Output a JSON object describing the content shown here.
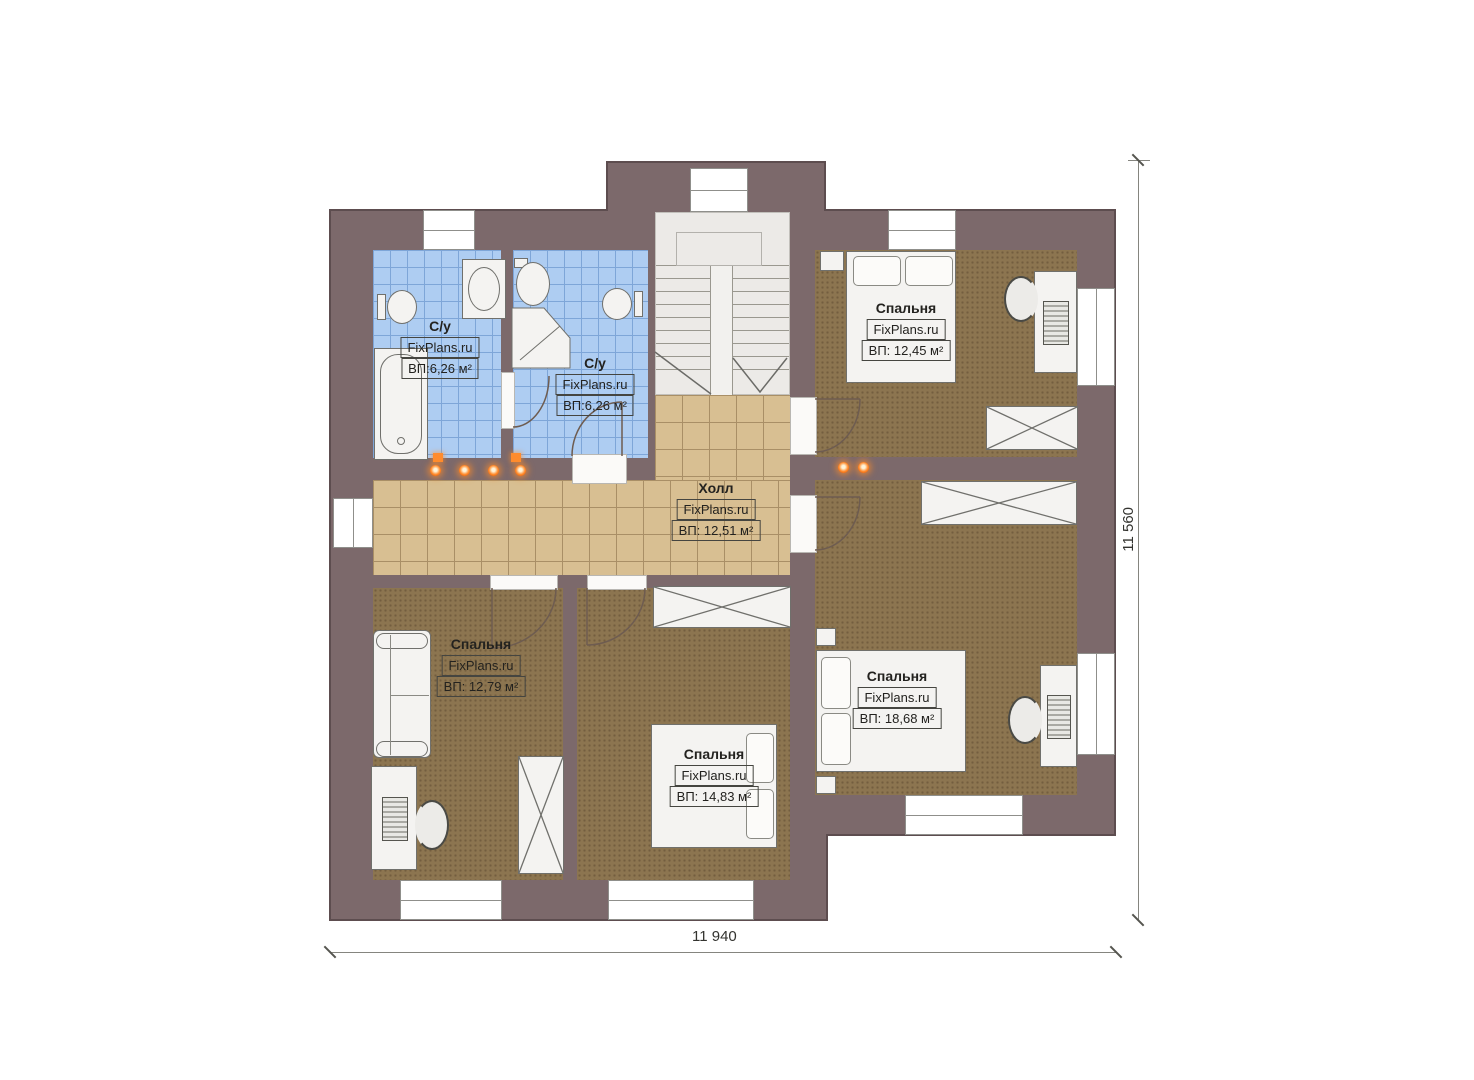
{
  "rooms": {
    "bath_left": {
      "name": "С/у",
      "brand": "FixPlans.ru",
      "area": "ВП:6,26 м²"
    },
    "bath_right": {
      "name": "С/у",
      "brand": "FixPlans.ru",
      "area": "ВП:6,26 м²"
    },
    "hall": {
      "name": "Холл",
      "brand": "FixPlans.ru",
      "area": "ВП: 12,51 м²"
    },
    "bedroom_top_right": {
      "name": "Спальня",
      "brand": "FixPlans.ru",
      "area": "ВП: 12,45 м²"
    },
    "bedroom_bottom_left": {
      "name": "Спальня",
      "brand": "FixPlans.ru",
      "area": "ВП: 12,79 м²"
    },
    "bedroom_bottom_middle": {
      "name": "Спальня",
      "brand": "FixPlans.ru",
      "area": "ВП: 14,83 м²"
    },
    "bedroom_right": {
      "name": "Спальня",
      "brand": "FixPlans.ru",
      "area": "ВП: 18,68 м²"
    }
  },
  "dimensions": {
    "width_total": "11 940",
    "height_total": "11 560"
  },
  "colors": {
    "wall": "#7c696b",
    "bathroom_floor": "#aecdf2",
    "hall_floor": "#d8bf92",
    "bedroom_floor": "#8c7550",
    "heater_accent": "#ff7a1e"
  }
}
